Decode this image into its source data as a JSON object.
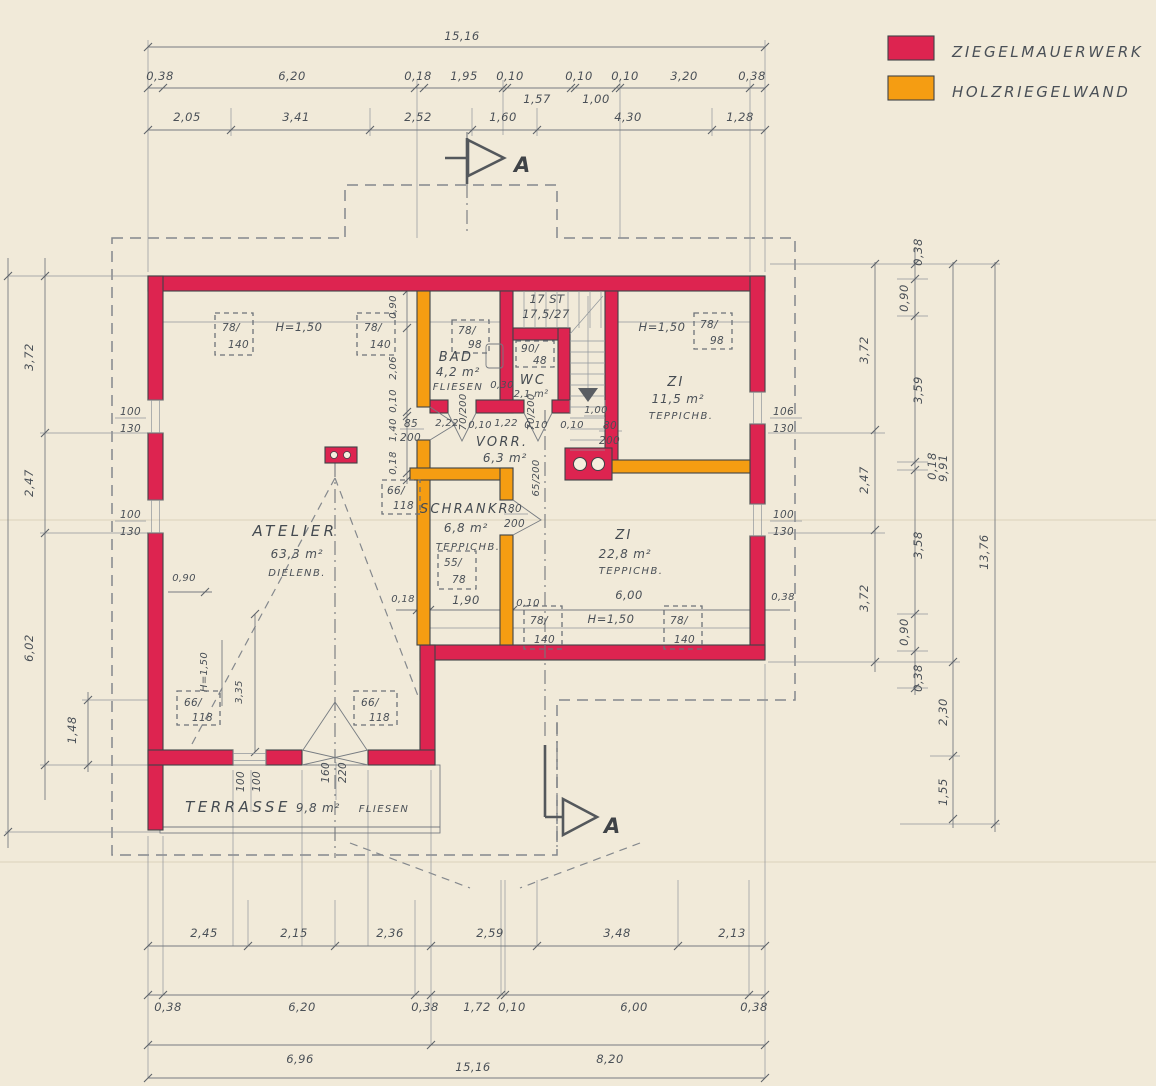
{
  "legend": {
    "brick_label": "ZIEGELMAUERWERK",
    "brick_color": "#dd2450",
    "timber_label": "HOLZRIEGELWAND",
    "timber_color": "#f59d12"
  },
  "section": {
    "label": "A"
  },
  "stair": {
    "count": "17 ST",
    "ratio": "17,5/27"
  },
  "rooms": {
    "atelier": {
      "name": "ATELIER",
      "area": "63,3 m²",
      "floor": "DIELENB."
    },
    "bad": {
      "name": "BAD",
      "area": "4,2 m²",
      "floor": "FLIESEN"
    },
    "wc": {
      "name": "WC",
      "area": "2,1 m²"
    },
    "vorr": {
      "name": "VORR.",
      "area": "6,3 m²"
    },
    "schrankr": {
      "name": "SCHRANKR.",
      "area": "6,8 m²",
      "floor": "TEPPICHB."
    },
    "zi1": {
      "name": "ZI",
      "area": "11,5 m²",
      "floor": "TEPPICHB."
    },
    "zi2": {
      "name": "ZI",
      "area": "22,8 m²",
      "floor": "TEPPICHB."
    },
    "terrasse": {
      "name": "TERRASSE",
      "area": "9,8 m²",
      "floor": "FLIESEN"
    }
  },
  "dims": {
    "top_total": "15,16",
    "top_r2": [
      "0,38",
      "6,20",
      "0,18",
      "1,95",
      "0,10",
      "0,10",
      "0,10",
      "3,20",
      "0,38"
    ],
    "top_r2b": [
      "1,57",
      "1,00"
    ],
    "top_r3": [
      "2,05",
      "3,41",
      "2,52",
      "1,60",
      "4,30",
      "1,28"
    ],
    "bottom_r1": [
      "2,45",
      "2,15",
      "2,36",
      "2,59",
      "3,48",
      "2,13"
    ],
    "bottom_r2": [
      "0,38",
      "6,20",
      "0,38",
      "1,72",
      "0,10",
      "6,00",
      "0,38"
    ],
    "bottom_r3": [
      "6,96",
      "8,20"
    ],
    "bottom_total": "15,16",
    "left": [
      "3,72",
      "2,47",
      "6,02",
      "1,48"
    ],
    "right_c1": [
      "3,72",
      "2,47",
      "3,72"
    ],
    "right_c2": [
      "0,38",
      "0,90",
      "3,59",
      "0,18",
      "3,58",
      "0,90",
      "0,38"
    ],
    "right_c3": [
      "9,91",
      "2,30",
      "1,55"
    ],
    "right_c4": "13,76",
    "mid_vchain": [
      "0,90",
      "2,06",
      "0,10",
      "1,40",
      "0,18"
    ],
    "vorr_row": [
      "2,22",
      "0,10",
      "1,22",
      "0,10"
    ],
    "vorr_extra": [
      "0,10",
      "1,00"
    ],
    "zi2_row": [
      "0,18",
      "1,90",
      "0,10",
      "6,00",
      "0,38"
    ],
    "bad_dim": "0,30",
    "atelier_left": "0,90",
    "atelier_h": "H=1,50",
    "atelier_v": "3,35",
    "h150_tl": "H=1,50",
    "h150_zi1": "H=1,50",
    "h150_zi2": "H=1,50"
  },
  "windows": {
    "tl1": {
      "a": "78/",
      "b": "140"
    },
    "tl2": {
      "a": "78/",
      "b": "140"
    },
    "bad": {
      "a": "78/",
      "b": "98"
    },
    "wc": {
      "a": "90/",
      "b": "48"
    },
    "zi1": {
      "a": "78/",
      "b": "98"
    },
    "schrank": {
      "a": "55/",
      "b": "78"
    },
    "b1": {
      "a": "78/",
      "b": "140"
    },
    "b2": {
      "a": "78/",
      "b": "140"
    },
    "a1": {
      "a": "66/",
      "b": "118"
    },
    "a2": {
      "a": "66/",
      "b": "118"
    },
    "a3": {
      "a": "66/",
      "b": "118"
    },
    "wl1": {
      "a": "100",
      "b": "130"
    },
    "wl2": {
      "a": "100",
      "b": "130"
    },
    "wr1": {
      "a": "106",
      "b": "130"
    },
    "wr2": {
      "a": "100",
      "b": "130"
    },
    "terr_win": {
      "a": "100",
      "b": "100"
    },
    "terr_door": {
      "a": "160",
      "b": "220"
    }
  },
  "doors": {
    "a": {
      "a": "85",
      "b": "200"
    },
    "bad": "70/200",
    "wc": "70/200",
    "landing": {
      "a": "80",
      "b": "200"
    },
    "schrank": {
      "a": "80",
      "b": "200"
    },
    "zi2": "65/200"
  }
}
